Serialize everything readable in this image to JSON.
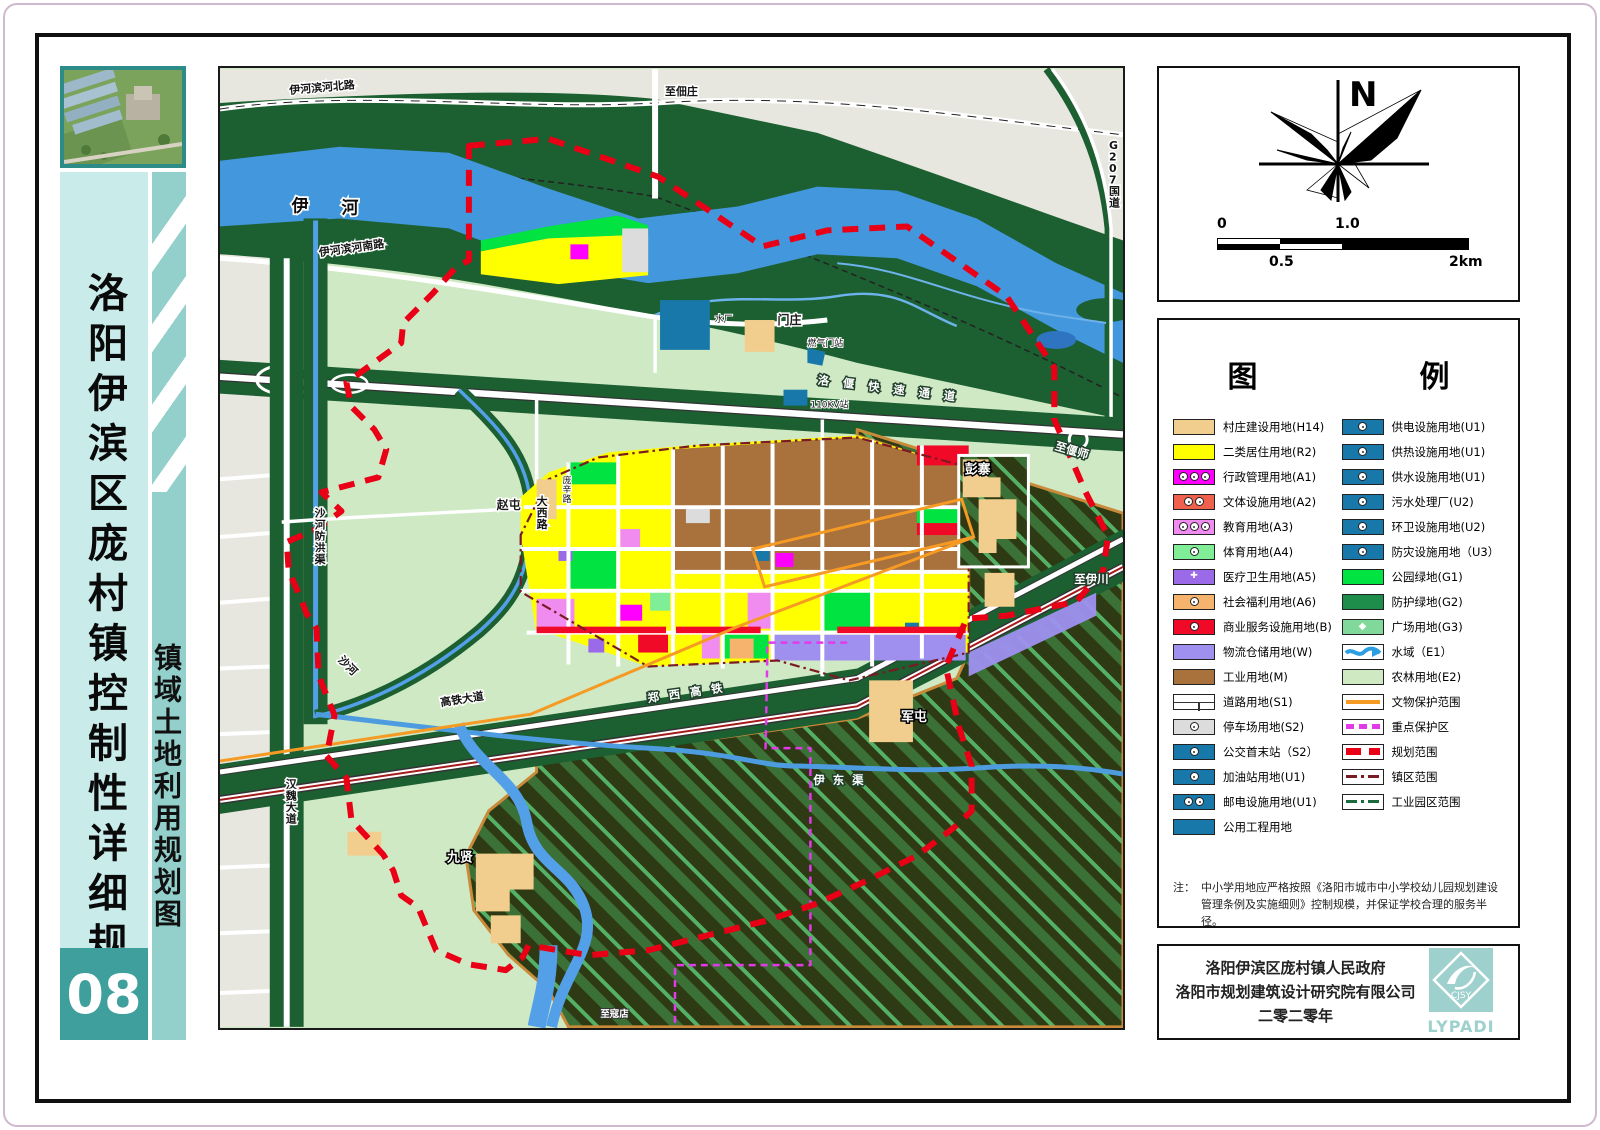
{
  "sidebar": {
    "title": "洛阳伊滨区庞村镇控制性详细规划",
    "subtitle": "镇域土地利用规划图",
    "sheet_number": "08",
    "thumbnail": "project-aerial-rendering"
  },
  "north_panel": {
    "north_label": "N",
    "scale": {
      "tick0": "0",
      "tick1": "1.0",
      "half": "0.5",
      "end": "2km"
    }
  },
  "legend": {
    "title": "图　　例",
    "left_items": [
      {
        "label": "村庄建设用地(H14)",
        "bg": "#F2CE8E"
      },
      {
        "label": "二类居住用地(R2)",
        "bg": "#FFFF00"
      },
      {
        "label": "行政管理用地(A1)",
        "bg": "#FF00FF",
        "icon": "c3"
      },
      {
        "label": "文体设施用地(A2)",
        "bg": "#F0614D",
        "icon": "c2"
      },
      {
        "label": "教育用地(A3)",
        "bg": "#F08CF0",
        "icon": "c3"
      },
      {
        "label": "体育用地(A4)",
        "bg": "#80EE96",
        "icon": "c1"
      },
      {
        "label": "医疗卫生用地(A5)",
        "bg": "#9A6AE8",
        "icon": "cross"
      },
      {
        "label": "社会福利用地(A6)",
        "bg": "#F5B36E",
        "icon": "c1"
      },
      {
        "label": "商业服务设施用地(B)",
        "bg": "#F00A28",
        "icon": "c1"
      },
      {
        "label": "物流仓储用地(W)",
        "bg": "#9F90F0"
      },
      {
        "label": "工业用地(M)",
        "bg": "#A9713C"
      },
      {
        "label": "道路用地(S1)",
        "bg": "#FFFFFF",
        "icon": "road"
      },
      {
        "label": "停车场用地(S2)",
        "bg": "#DCDCDC",
        "icon": "c1"
      },
      {
        "label": "公交首末站（S2）",
        "bg": "#1878AA",
        "icon": "c1"
      },
      {
        "label": "加油站用地(U1)",
        "bg": "#1878AA",
        "icon": "c1"
      },
      {
        "label": "邮电设施用地(U1)",
        "bg": "#1878AA",
        "icon": "c2"
      },
      {
        "label": "公用工程用地",
        "bg": "#1878AA"
      }
    ],
    "right_items": [
      {
        "label": "供电设施用地(U1)",
        "bg": "#1878AA",
        "icon": "c1"
      },
      {
        "label": "供热设施用地(U1)",
        "bg": "#1878AA",
        "icon": "c1"
      },
      {
        "label": "供水设施用地(U1)",
        "bg": "#1878AA",
        "icon": "c1"
      },
      {
        "label": "污水处理厂(U2)",
        "bg": "#1878AA",
        "icon": "c1"
      },
      {
        "label": "环卫设施用地(U2)",
        "bg": "#1878AA",
        "icon": "c1"
      },
      {
        "label": "防灾设施用地（U3）",
        "bg": "#1878AA",
        "icon": "c1"
      },
      {
        "label": "公园绿地(G1)",
        "bg": "#00E341"
      },
      {
        "label": "防护绿地(G2)",
        "bg": "#1E8C4A"
      },
      {
        "label": "广场用地(G3)",
        "bg": "#80D89A",
        "icon": "diamond"
      },
      {
        "label": "水域（E1）",
        "bg": "#FFFFFF",
        "icon": "wave"
      },
      {
        "label": "农林用地(E2)",
        "bg": "#CFEAC2"
      },
      {
        "label": "文物保护范围",
        "line": {
          "color": "#F59A23",
          "style": "solid"
        }
      },
      {
        "label": "重点保护区",
        "line": {
          "color": "#E23AE9",
          "style": "dash"
        }
      },
      {
        "label": "规划范围",
        "line": {
          "color": "#E90016",
          "style": "dash2"
        }
      },
      {
        "label": "镇区范围",
        "line": {
          "color": "#7A1A22",
          "style": "dashdot"
        }
      },
      {
        "label": "工业园区范围",
        "line": {
          "color": "#1A6B3C",
          "style": "dashdot"
        }
      }
    ],
    "note_prefix": "注：",
    "note": "中小学用地应严格按照《洛阳市城市中小学校幼儿园规划建设管理条例及实施细则》控制规模，并保证学校合理的服务半径。"
  },
  "title_block": {
    "line1": "洛阳伊滨区庞村镇人民政府",
    "line2": "洛阳市规划建筑设计研究院有限公司",
    "line3": "二零二零年",
    "logo_text": "CJSY",
    "logo_caption": "LYPADI"
  },
  "map": {
    "labels": [
      {
        "t": "伊河滨河北路",
        "x": 70,
        "y": 25,
        "r": -5,
        "c": "m-road"
      },
      {
        "t": "至佃庄",
        "x": 447,
        "y": 26,
        "c": "m-road"
      },
      {
        "t": "G207国道",
        "x": 893,
        "y": 80,
        "v": 1,
        "c": "m-road"
      },
      {
        "t": "伊",
        "x": 72,
        "y": 143,
        "c": "m-big"
      },
      {
        "t": "河",
        "x": 122,
        "y": 145,
        "c": "m-big"
      },
      {
        "t": "伊河滨河南路",
        "x": 100,
        "y": 188,
        "r": -8,
        "c": "m-road"
      },
      {
        "t": "洛偃快速通道",
        "x": 600,
        "y": 316,
        "r": 7,
        "c": "m-roadw",
        "ls": 14
      },
      {
        "t": "至偃师",
        "x": 838,
        "y": 382,
        "r": 16,
        "c": "m-roadw"
      },
      {
        "t": "至伊川",
        "x": 858,
        "y": 516,
        "c": "m-roadw"
      },
      {
        "t": "彭寨",
        "x": 748,
        "y": 406,
        "c": "m-village"
      },
      {
        "t": "军屯",
        "x": 684,
        "y": 655,
        "c": "m-village"
      },
      {
        "t": "九贤",
        "x": 228,
        "y": 796,
        "c": "m-village"
      },
      {
        "t": "门庄",
        "x": 560,
        "y": 256,
        "c": "m-dark"
      },
      {
        "t": "赵屯",
        "x": 278,
        "y": 442,
        "c": "m-dark"
      },
      {
        "t": "水厂",
        "x": 497,
        "y": 254,
        "c": "m-tiny"
      },
      {
        "t": "燃气门站",
        "x": 590,
        "y": 278,
        "c": "m-tiny"
      },
      {
        "t": "110KV站",
        "x": 593,
        "y": 340,
        "c": "m-tiny"
      },
      {
        "t": "庞辛路",
        "x": 344,
        "y": 416,
        "v": 1,
        "c": "m-tiny"
      },
      {
        "t": "大西路",
        "x": 318,
        "y": 438,
        "v": 1,
        "c": "m-road"
      },
      {
        "t": "沙河防洪渠",
        "x": 95,
        "y": 450,
        "v": 1,
        "c": "m-road"
      },
      {
        "t": "汉魏大道",
        "x": 66,
        "y": 722,
        "v": 1,
        "c": "m-road"
      },
      {
        "t": "高铁大道",
        "x": 222,
        "y": 640,
        "r": -9,
        "c": "m-road"
      },
      {
        "t": "郑西高铁",
        "x": 430,
        "y": 636,
        "r": -8,
        "c": "m-roadw",
        "ls": 10
      },
      {
        "t": "伊东渠",
        "x": 596,
        "y": 718,
        "c": "m-roadw",
        "ls": 8
      },
      {
        "t": "沙河",
        "x": 118,
        "y": 594,
        "r": 45,
        "c": "m-road"
      },
      {
        "t": "至寇店",
        "x": 382,
        "y": 952,
        "c": "m-tinyw"
      }
    ]
  },
  "colors": {
    "accent_teal": "#3F9F9C",
    "sidebar_light": "#C9ECEA",
    "sidebar_stripe": "#93CFCB",
    "boundary_red": "#E90016",
    "protect_magenta": "#E23AE9",
    "relic_orange": "#F59A23",
    "town_boundary_maroon": "#7A1A22",
    "industry_park_green": "#1A6B3C",
    "river_blue": "#4397DC",
    "farmland_green": "#CFE9C4",
    "protective_green": "#1C5F31"
  }
}
